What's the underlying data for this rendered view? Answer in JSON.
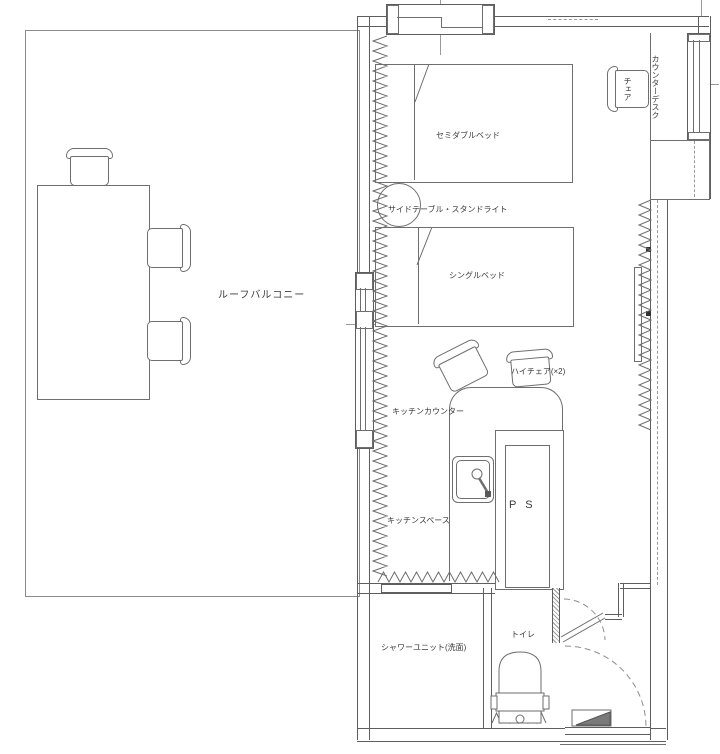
{
  "floor_plan": {
    "balcony": {
      "name": "ルーフバルコニー"
    },
    "bedroom": {
      "semi_double_bed": "セミダブルベッド",
      "side_table_stand_light": "サイドテーブル・スタンドライト",
      "single_bed": "シングルベッド",
      "desk_chair": "チェア",
      "counter_desk": "カウンターデスク"
    },
    "kitchen": {
      "high_chairs": "ハイチェア(×2)",
      "counter": "キッチンカウンター",
      "space": "キッチンスペース",
      "pipe_space": "P S"
    },
    "sanitary": {
      "shower_unit": "シャワーユニット(洗面)",
      "toilet": "トイレ"
    }
  }
}
